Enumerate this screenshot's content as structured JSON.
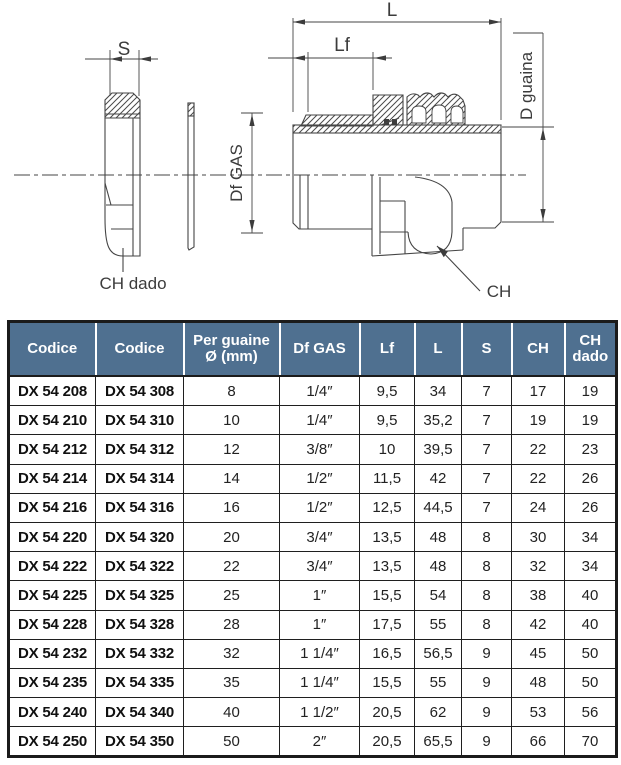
{
  "drawing": {
    "line_color": "#454545",
    "labels": {
      "s": "S",
      "lf": "Lf",
      "l": "L",
      "df_gas": "Df GAS",
      "d_guaina": "D guaina",
      "ch": "CH",
      "ch_dado": "CH dado"
    }
  },
  "table": {
    "header_bg": "#4f7090",
    "headers": [
      "Codice",
      "Codice",
      "Per guaine Ø (mm)",
      "Df GAS",
      "Lf",
      "L",
      "S",
      "CH",
      "CH dado"
    ],
    "rows": [
      [
        "DX 54 208",
        "DX 54 308",
        "8",
        "1/4″",
        "9,5",
        "34",
        "7",
        "17",
        "19"
      ],
      [
        "DX 54 210",
        "DX 54 310",
        "10",
        "1/4″",
        "9,5",
        "35,2",
        "7",
        "19",
        "19"
      ],
      [
        "DX 54 212",
        "DX 54 312",
        "12",
        "3/8″",
        "10",
        "39,5",
        "7",
        "22",
        "23"
      ],
      [
        "DX 54 214",
        "DX 54 314",
        "14",
        "1/2″",
        "11,5",
        "42",
        "7",
        "22",
        "26"
      ],
      [
        "DX 54 216",
        "DX 54 316",
        "16",
        "1/2″",
        "12,5",
        "44,5",
        "7",
        "24",
        "26"
      ],
      [
        "DX 54 220",
        "DX 54 320",
        "20",
        "3/4″",
        "13,5",
        "48",
        "8",
        "30",
        "34"
      ],
      [
        "DX 54 222",
        "DX 54 322",
        "22",
        "3/4″",
        "13,5",
        "48",
        "8",
        "32",
        "34"
      ],
      [
        "DX 54 225",
        "DX 54 325",
        "25",
        "1″",
        "15,5",
        "54",
        "8",
        "38",
        "40"
      ],
      [
        "DX 54 228",
        "DX 54 328",
        "28",
        "1″",
        "17,5",
        "55",
        "8",
        "42",
        "40"
      ],
      [
        "DX 54 232",
        "DX 54 332",
        "32",
        "1 1/4″",
        "16,5",
        "56,5",
        "9",
        "45",
        "50"
      ],
      [
        "DX 54 235",
        "DX 54 335",
        "35",
        "1 1/4″",
        "15,5",
        "55",
        "9",
        "48",
        "50"
      ],
      [
        "DX 54 240",
        "DX 54 340",
        "40",
        "1 1/2″",
        "20,5",
        "62",
        "9",
        "53",
        "56"
      ],
      [
        "DX 54 250",
        "DX 54 350",
        "50",
        "2″",
        "20,5",
        "65,5",
        "9",
        "66",
        "70"
      ]
    ]
  }
}
